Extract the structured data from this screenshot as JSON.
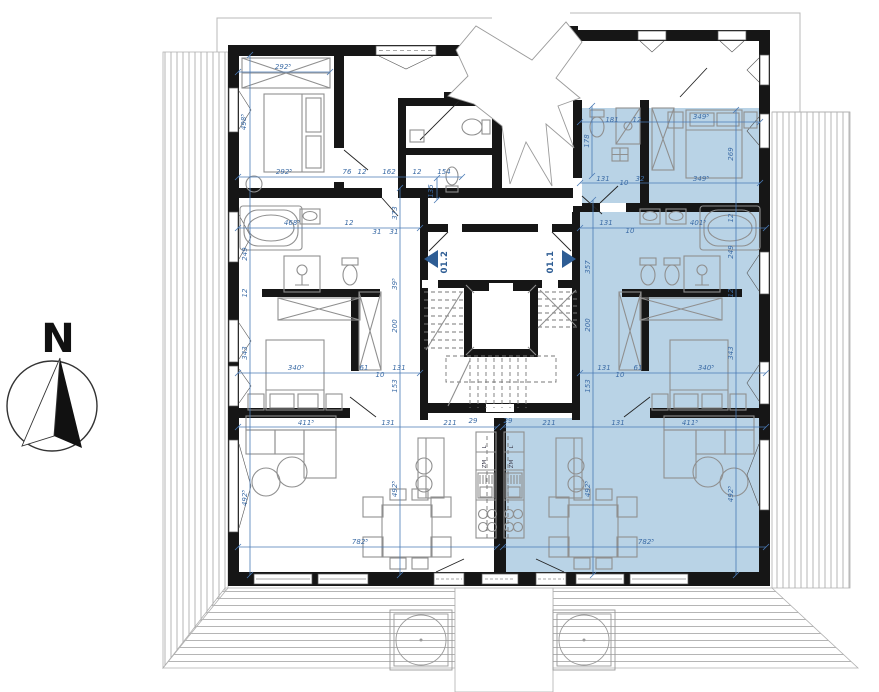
{
  "compass": {
    "label": "N"
  },
  "units": [
    {
      "id": "unit-01-2",
      "label": "01.2",
      "dir": "left",
      "selected": false
    },
    {
      "id": "unit-01-1",
      "label": "01.1",
      "dir": "right",
      "selected": true
    }
  ],
  "kitchen_labels": {
    "left": [
      "L",
      "ZM"
    ],
    "right": [
      "L",
      "ZM"
    ]
  },
  "colors": {
    "highlight": "#b9d3e6",
    "dim_line": "#4a7ab5",
    "dim_text": "#3c6ca6",
    "wall": "#161616",
    "furniture": "#8f8f8f",
    "marker": "#2e5d94"
  },
  "dim_lines": [
    [
      238,
      72,
      330,
      72
    ],
    [
      238,
      177,
      462,
      177
    ],
    [
      580,
      122,
      760,
      122
    ],
    [
      580,
      183,
      760,
      183
    ],
    [
      238,
      228,
      420,
      228
    ],
    [
      580,
      228,
      766,
      228
    ],
    [
      238,
      373,
      420,
      373
    ],
    [
      580,
      373,
      766,
      373
    ],
    [
      238,
      427,
      497,
      427
    ],
    [
      503,
      427,
      766,
      427
    ],
    [
      238,
      547,
      497,
      547
    ],
    [
      503,
      547,
      766,
      547
    ],
    [
      250,
      55,
      250,
      575
    ],
    [
      400,
      188,
      400,
      575
    ],
    [
      437,
      178,
      437,
      200
    ],
    [
      592,
      106,
      592,
      176
    ],
    [
      593,
      200,
      593,
      575
    ],
    [
      736,
      110,
      736,
      575
    ]
  ],
  "dim_labels": [
    {
      "t": "292⁵",
      "x": 283,
      "y": 69,
      "r": 0
    },
    {
      "t": "498⁵",
      "x": 246,
      "y": 122,
      "r": 1
    },
    {
      "t": "292⁵",
      "x": 284,
      "y": 174,
      "r": 0
    },
    {
      "t": "76",
      "x": 347,
      "y": 174,
      "r": 0
    },
    {
      "t": "12",
      "x": 362,
      "y": 174,
      "r": 0
    },
    {
      "t": "162",
      "x": 389,
      "y": 174,
      "r": 0
    },
    {
      "t": "12",
      "x": 417,
      "y": 174,
      "r": 0
    },
    {
      "t": "154",
      "x": 444,
      "y": 174,
      "r": 0
    },
    {
      "t": "135",
      "x": 433,
      "y": 191,
      "r": 1
    },
    {
      "t": "468⁵",
      "x": 292,
      "y": 225,
      "r": 0
    },
    {
      "t": "12",
      "x": 349,
      "y": 225,
      "r": 0
    },
    {
      "t": "31",
      "x": 377,
      "y": 234,
      "r": 0
    },
    {
      "t": "31",
      "x": 394,
      "y": 234,
      "r": 0
    },
    {
      "t": "373",
      "x": 397,
      "y": 213,
      "r": 1
    },
    {
      "t": "249",
      "x": 247,
      "y": 254,
      "r": 1
    },
    {
      "t": "12",
      "x": 247,
      "y": 293,
      "r": 1
    },
    {
      "t": "343",
      "x": 247,
      "y": 353,
      "r": 1
    },
    {
      "t": "340⁵",
      "x": 296,
      "y": 370,
      "r": 0
    },
    {
      "t": "61",
      "x": 364,
      "y": 370,
      "r": 0
    },
    {
      "t": "10",
      "x": 380,
      "y": 377,
      "r": 0
    },
    {
      "t": "131",
      "x": 399,
      "y": 370,
      "r": 0
    },
    {
      "t": "39⁵",
      "x": 397,
      "y": 284,
      "r": 1
    },
    {
      "t": "200",
      "x": 397,
      "y": 326,
      "r": 1
    },
    {
      "t": "153",
      "x": 397,
      "y": 386,
      "r": 1
    },
    {
      "t": "411⁵",
      "x": 306,
      "y": 425,
      "r": 0
    },
    {
      "t": "131",
      "x": 388,
      "y": 425,
      "r": 0
    },
    {
      "t": "211",
      "x": 450,
      "y": 425,
      "r": 0
    },
    {
      "t": "29",
      "x": 473,
      "y": 423,
      "r": 0
    },
    {
      "t": "492⁵",
      "x": 247,
      "y": 498,
      "r": 1
    },
    {
      "t": "492⁵",
      "x": 397,
      "y": 489,
      "r": 1
    },
    {
      "t": "782⁵",
      "x": 360,
      "y": 544,
      "r": 0
    },
    {
      "t": "181",
      "x": 612,
      "y": 122,
      "r": 0
    },
    {
      "t": "12",
      "x": 637,
      "y": 122,
      "r": 0
    },
    {
      "t": "178",
      "x": 589,
      "y": 141,
      "r": 1
    },
    {
      "t": "349⁵",
      "x": 701,
      "y": 119,
      "r": 0
    },
    {
      "t": "269",
      "x": 733,
      "y": 154,
      "r": 1
    },
    {
      "t": "349⁵",
      "x": 701,
      "y": 181,
      "r": 0
    },
    {
      "t": "131",
      "x": 603,
      "y": 181,
      "r": 0
    },
    {
      "t": "10",
      "x": 624,
      "y": 185,
      "r": 0
    },
    {
      "t": "32",
      "x": 640,
      "y": 181,
      "r": 0
    },
    {
      "t": "131",
      "x": 606,
      "y": 225,
      "r": 0
    },
    {
      "t": "10",
      "x": 630,
      "y": 233,
      "r": 0
    },
    {
      "t": "401⁵",
      "x": 698,
      "y": 225,
      "r": 0
    },
    {
      "t": "12",
      "x": 733,
      "y": 218,
      "r": 1
    },
    {
      "t": "249",
      "x": 733,
      "y": 252,
      "r": 1
    },
    {
      "t": "357",
      "x": 590,
      "y": 267,
      "r": 1
    },
    {
      "t": "12",
      "x": 733,
      "y": 293,
      "r": 1
    },
    {
      "t": "343",
      "x": 733,
      "y": 353,
      "r": 1
    },
    {
      "t": "131",
      "x": 604,
      "y": 370,
      "r": 0
    },
    {
      "t": "10",
      "x": 620,
      "y": 377,
      "r": 0
    },
    {
      "t": "61",
      "x": 638,
      "y": 370,
      "r": 0
    },
    {
      "t": "340⁵",
      "x": 706,
      "y": 370,
      "r": 0
    },
    {
      "t": "200",
      "x": 590,
      "y": 325,
      "r": 1
    },
    {
      "t": "153",
      "x": 590,
      "y": 386,
      "r": 1
    },
    {
      "t": "211",
      "x": 549,
      "y": 425,
      "r": 0
    },
    {
      "t": "29",
      "x": 508,
      "y": 423,
      "r": 0
    },
    {
      "t": "131",
      "x": 618,
      "y": 425,
      "r": 0
    },
    {
      "t": "411⁵",
      "x": 690,
      "y": 425,
      "r": 0
    },
    {
      "t": "492⁵",
      "x": 590,
      "y": 489,
      "r": 1
    },
    {
      "t": "492⁵",
      "x": 733,
      "y": 494,
      "r": 1
    },
    {
      "t": "782⁵",
      "x": 646,
      "y": 544,
      "r": 0
    }
  ]
}
